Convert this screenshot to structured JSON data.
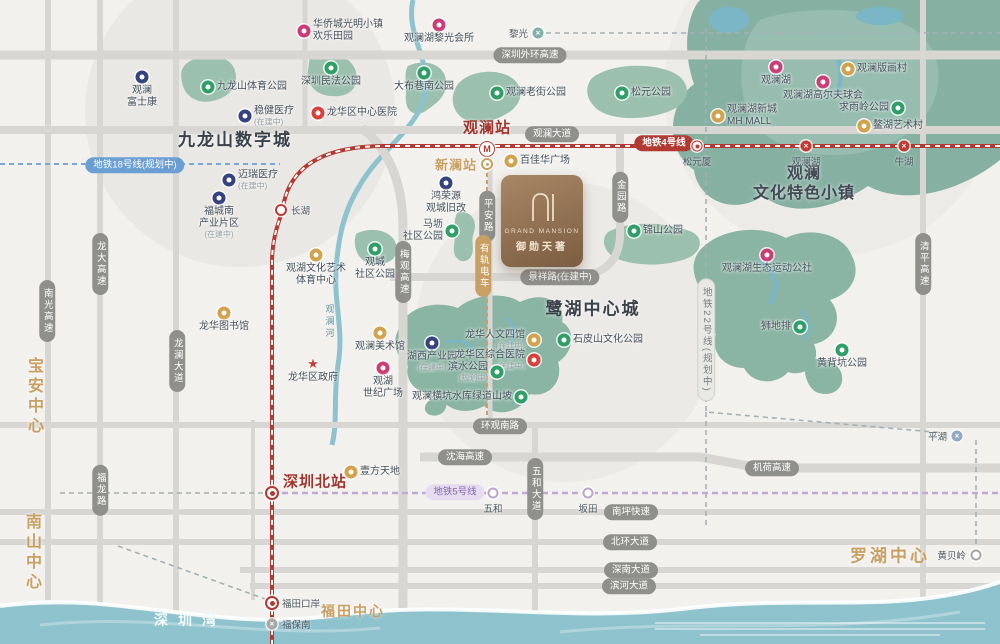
{
  "project": {
    "name_en": "GRAND MANSION",
    "name_cn": "御勋天著"
  },
  "colors": {
    "brand_gold": "#c9a063",
    "metro_line4_red": "#b23a32",
    "metro_line5_purple": "#b9a6cc",
    "park_green": "#8ab5a4",
    "water_blue": "#8ec2cd",
    "logo_brown": "#8a6b4e",
    "label_dark": "#3c434c"
  },
  "areas": [
    {
      "t": "九龙山数字城",
      "x": 235,
      "y": 138,
      "cls": "ar-dark"
    },
    {
      "t": "鹭湖中心城",
      "x": 593,
      "y": 307,
      "cls": "ar-dark"
    },
    {
      "t": "观澜\n文化特色小镇",
      "x": 804,
      "y": 184,
      "cls": "ar-dark2"
    },
    {
      "t": "宝安中心",
      "x": 33,
      "y": 397,
      "cls": "ar-gold-v"
    },
    {
      "t": "南山中心",
      "x": 31,
      "y": 553,
      "cls": "ar-gold-v"
    },
    {
      "t": "罗湖中心",
      "x": 890,
      "y": 554,
      "cls": "ar-gold"
    },
    {
      "t": "福田中心",
      "x": 353,
      "y": 611,
      "cls": "ar-gold-sm"
    },
    {
      "t": "深圳湾",
      "x": 190,
      "y": 620,
      "cls": "ar-bay"
    },
    {
      "t": "观澜河",
      "x": 330,
      "y": 322,
      "cls": "ar-river"
    }
  ],
  "pills": [
    {
      "t": "深圳外环高速",
      "x": 530,
      "y": 55,
      "style": "gray"
    },
    {
      "t": "观澜大道",
      "x": 552,
      "y": 134,
      "style": "gray"
    },
    {
      "t": "地铁4号线",
      "x": 664,
      "y": 143,
      "style": "red"
    },
    {
      "t": "地铁18号线(规划中)",
      "x": 135,
      "y": 165,
      "style": "blue"
    },
    {
      "t": "景祥路(在建中)",
      "x": 560,
      "y": 277,
      "style": "gray"
    },
    {
      "t": "环观南路",
      "x": 500,
      "y": 426,
      "style": "gray"
    },
    {
      "t": "沈海高速",
      "x": 465,
      "y": 457,
      "style": "gray"
    },
    {
      "t": "机荷高速",
      "x": 772,
      "y": 468,
      "style": "gray"
    },
    {
      "t": "地铁5号线",
      "x": 455,
      "y": 492,
      "style": "purple"
    },
    {
      "t": "南坪快速",
      "x": 631,
      "y": 512,
      "style": "gray"
    },
    {
      "t": "北环大道",
      "x": 630,
      "y": 542,
      "style": "gray"
    },
    {
      "t": "深南大道",
      "x": 631,
      "y": 570,
      "style": "gray"
    },
    {
      "t": "滨河大道",
      "x": 629,
      "y": 586,
      "style": "gray"
    },
    {
      "t": "龙大高速",
      "x": 100,
      "y": 264,
      "v": true,
      "style": "gray"
    },
    {
      "t": "南光高速",
      "x": 47,
      "y": 311,
      "v": true,
      "style": "gray"
    },
    {
      "t": "龙澜大道",
      "x": 177,
      "y": 361,
      "v": true,
      "style": "gray"
    },
    {
      "t": "梅观高速",
      "x": 403,
      "y": 272,
      "v": true,
      "style": "gray"
    },
    {
      "t": "平安路",
      "x": 487,
      "y": 216,
      "v": true,
      "style": "gray"
    },
    {
      "t": "有轨电车",
      "x": 483,
      "y": 266,
      "v": true,
      "style": "gold"
    },
    {
      "t": "金园路",
      "x": 620,
      "y": 197,
      "v": true,
      "style": "gray"
    },
    {
      "t": "地铁22号线(规划中)",
      "x": 706,
      "y": 340,
      "v": true,
      "style": "lightgray"
    },
    {
      "t": "清平高速",
      "x": 923,
      "y": 264,
      "v": true,
      "style": "gray"
    },
    {
      "t": "五和大道",
      "x": 535,
      "y": 489,
      "v": true,
      "style": "gray"
    },
    {
      "t": "福龙路",
      "x": 100,
      "y": 490,
      "v": true,
      "style": "gray"
    }
  ],
  "stations": [
    {
      "label": "观澜站",
      "x": 487,
      "y": 149,
      "type": "metro",
      "glyph": "M",
      "pos": "custom",
      "lx": 487,
      "ly": 127,
      "cls": "st-big"
    },
    {
      "label": "新澜站",
      "x": 487,
      "y": 164,
      "type": "tram",
      "pos": "left",
      "cls": "st-gold"
    },
    {
      "label": "长湖",
      "x": 281,
      "y": 210,
      "type": "ring-red",
      "pos": "right"
    },
    {
      "label": "黎光",
      "x": 538,
      "y": 33,
      "type": "x-teal",
      "glyph": "×",
      "pos": "left"
    },
    {
      "label": "松元厦",
      "x": 697,
      "y": 146,
      "type": "dot-red",
      "pos": "below"
    },
    {
      "label": "观澜湖",
      "x": 806,
      "y": 146,
      "type": "x-red",
      "glyph": "×",
      "pos": "below"
    },
    {
      "label": "牛湖",
      "x": 904,
      "y": 146,
      "type": "x-red",
      "glyph": "×",
      "pos": "below"
    },
    {
      "label": "深圳北站",
      "x": 272,
      "y": 493,
      "type": "bull-red",
      "pos": "custom",
      "lx": 315,
      "ly": 481,
      "cls": "st-big"
    },
    {
      "label": "五和",
      "x": 493,
      "y": 493,
      "type": "ring-purple",
      "pos": "below"
    },
    {
      "label": "坂田",
      "x": 588,
      "y": 493,
      "type": "ring-purple",
      "pos": "below"
    },
    {
      "label": "平湖",
      "x": 957,
      "y": 436,
      "type": "x-slate",
      "glyph": "×",
      "pos": "left"
    },
    {
      "label": "黄贝岭",
      "x": 976,
      "y": 555,
      "type": "ring-gray",
      "pos": "left"
    },
    {
      "label": "福田口岸",
      "x": 272,
      "y": 603,
      "type": "bull-red",
      "pos": "right"
    },
    {
      "label": "福保南",
      "x": 272,
      "y": 624,
      "type": "x-gray",
      "glyph": "×",
      "pos": "right"
    }
  ],
  "pois": [
    {
      "label": "华侨城光明小镇\n欢乐田园",
      "icon": "pink",
      "x": 304,
      "y": 31,
      "pos": "right"
    },
    {
      "label": "观澜\n富士康",
      "icon": "blue",
      "x": 142,
      "y": 77,
      "pos": "below"
    },
    {
      "label": "九龙山体育公园",
      "icon": "green",
      "x": 208,
      "y": 87,
      "pos": "right"
    },
    {
      "label": "深圳民法公园",
      "icon": "green",
      "x": 331,
      "y": 68,
      "pos": "below"
    },
    {
      "label": "稳健医疗",
      "sub": "(在建中)",
      "icon": "blue",
      "x": 245,
      "y": 116,
      "pos": "right"
    },
    {
      "label": "龙华区中心医院",
      "icon": "red",
      "x": 318,
      "y": 113,
      "pos": "right"
    },
    {
      "label": "迈瑞医疗",
      "sub": "(在建中)",
      "icon": "blue",
      "x": 229,
      "y": 180,
      "pos": "right"
    },
    {
      "label": "福城南\n产业片区",
      "sub": "(在建中)",
      "icon": "blue",
      "x": 219,
      "y": 198,
      "pos": "below"
    },
    {
      "label": "观澜湖黎光会所",
      "icon": "pink",
      "x": 439,
      "y": 25,
      "pos": "below"
    },
    {
      "label": "大布巷南公园",
      "icon": "green",
      "x": 424,
      "y": 73,
      "pos": "below"
    },
    {
      "label": "观澜老街公园",
      "icon": "green",
      "x": 497,
      "y": 93,
      "pos": "right"
    },
    {
      "label": "松元公园",
      "icon": "green",
      "x": 622,
      "y": 93,
      "pos": "right"
    },
    {
      "label": "观澜湖",
      "icon": "pink",
      "x": 776,
      "y": 67,
      "pos": "below"
    },
    {
      "label": "观澜版画村",
      "icon": "gold",
      "x": 848,
      "y": 69,
      "pos": "right"
    },
    {
      "label": "观澜湖高尔夫球会",
      "icon": "pink",
      "x": 823,
      "y": 82,
      "pos": "below"
    },
    {
      "label": "求雨岭公园",
      "icon": "green",
      "x": 898,
      "y": 108,
      "pos": "left"
    },
    {
      "label": "观澜湖新城\nMH MALL",
      "icon": "gold",
      "x": 718,
      "y": 116,
      "pos": "right"
    },
    {
      "label": "鳌湖艺术村",
      "icon": "gold",
      "x": 864,
      "y": 126,
      "pos": "right"
    },
    {
      "label": "百佳华广场",
      "icon": "gold",
      "x": 511,
      "y": 161,
      "pos": "right"
    },
    {
      "label": "鸿荣源\n观城旧改",
      "icon": "blue",
      "x": 446,
      "y": 183,
      "pos": "below"
    },
    {
      "label": "马坜\n社区公园",
      "icon": "green",
      "x": 452,
      "y": 231,
      "pos": "left"
    },
    {
      "label": "观湖文化艺术\n体育中心",
      "icon": "gold",
      "x": 316,
      "y": 255,
      "pos": "below"
    },
    {
      "label": "观城\n社区公园",
      "icon": "green",
      "x": 375,
      "y": 249,
      "pos": "below"
    },
    {
      "label": "观澜美术馆",
      "icon": "gold",
      "x": 380,
      "y": 333,
      "pos": "below"
    },
    {
      "label": "龙华区政府",
      "icon": "star",
      "x": 313,
      "y": 364,
      "pos": "below"
    },
    {
      "label": "观湖\n世纪广场",
      "icon": "pink",
      "x": 383,
      "y": 368,
      "pos": "below"
    },
    {
      "label": "龙华图书馆",
      "icon": "gold",
      "x": 224,
      "y": 313,
      "pos": "below"
    },
    {
      "label": "湖西产业园",
      "sub": "(在建中)",
      "icon": "blue",
      "x": 432,
      "y": 343,
      "pos": "below"
    },
    {
      "label": "龙华人文四馆",
      "sub": "(在建中)",
      "icon": "gold",
      "x": 534,
      "y": 340,
      "pos": "left"
    },
    {
      "label": "龙华区综合医院",
      "sub": "(在建中)",
      "icon": "red",
      "x": 534,
      "y": 360,
      "pos": "left"
    },
    {
      "label": "滨水公园",
      "sub": "(规划中)",
      "icon": "green",
      "x": 497,
      "y": 372,
      "pos": "left"
    },
    {
      "label": "石皮山文化公园",
      "icon": "green",
      "x": 564,
      "y": 340,
      "pos": "right"
    },
    {
      "label": "观澜横坑水库绿道山坡",
      "icon": "green",
      "x": 521,
      "y": 397,
      "pos": "left"
    },
    {
      "label": "观澜湖生态运动公社",
      "icon": "pink",
      "x": 767,
      "y": 255,
      "pos": "below"
    },
    {
      "label": "狮地排",
      "icon": "green",
      "x": 800,
      "y": 327,
      "pos": "left"
    },
    {
      "label": "黄背坑公园",
      "icon": "green",
      "x": 842,
      "y": 350,
      "pos": "below"
    },
    {
      "label": "锦山公园",
      "icon": "green",
      "x": 634,
      "y": 231,
      "pos": "right"
    },
    {
      "label": "壹方天地",
      "icon": "gold",
      "x": 351,
      "y": 472,
      "pos": "right"
    }
  ]
}
